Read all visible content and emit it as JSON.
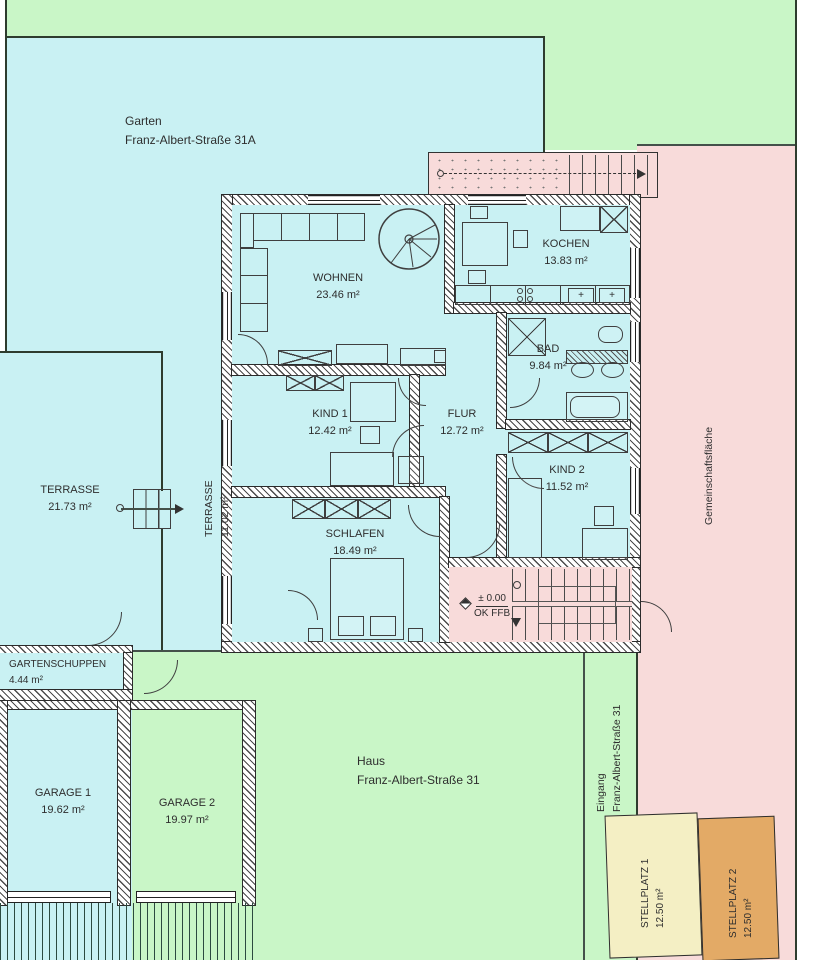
{
  "site": {
    "garten": {
      "line1": "Garten",
      "line2": "Franz-Albert-Straße 31A"
    },
    "haus": {
      "line1": "Haus",
      "line2": "Franz-Albert-Straße 31"
    },
    "eingang": {
      "line1": "Eingang",
      "line2": "Franz-Albert-Straße 31"
    },
    "gemeinschaftsflaeche": "Gemeinschaftsfläche"
  },
  "rooms": {
    "wohnen": {
      "name": "WOHNEN",
      "area": "23.46 m²"
    },
    "kochen": {
      "name": "KOCHEN",
      "area": "13.83 m²"
    },
    "bad": {
      "name": "BAD",
      "area": "9.84 m²"
    },
    "kind1": {
      "name": "KIND 1",
      "area": "12.42 m²"
    },
    "flur": {
      "name": "FLUR",
      "area": "12.72 m²"
    },
    "kind2": {
      "name": "KIND 2",
      "area": "11.52 m²"
    },
    "schlafen": {
      "name": "SCHLAFEN",
      "area": "18.49 m²"
    },
    "terrasse1": {
      "name": "TERRASSE",
      "area": "21.73 m²"
    },
    "terrasse2": {
      "name": "TERRASSE",
      "area": "11.02 m²"
    }
  },
  "outbuildings": {
    "gartenschuppen": {
      "name": "GARTENSCHUPPEN",
      "area": "4.44 m²"
    },
    "garage1": {
      "name": "GARAGE 1",
      "area": "19.62 m²"
    },
    "garage2": {
      "name": "GARAGE 2",
      "area": "19.97 m²"
    },
    "stellplatz1": {
      "name": "STELLPLATZ 1",
      "area": "12.50 m²"
    },
    "stellplatz2": {
      "name": "STELLPLATZ 2",
      "area": "12.50 m²"
    }
  },
  "annotations": {
    "level": "± 0.00",
    "level_ref": "OK FFB"
  },
  "colors": {
    "garden_cyan": "#c9f1f3",
    "lawn_green": "#c9f6c7",
    "common_pink": "#f8dbda",
    "stellplatz1_yellow": "#f4efc4",
    "stellplatz2_orange": "#e3aa66",
    "line_dark": "#2e3c2e"
  }
}
